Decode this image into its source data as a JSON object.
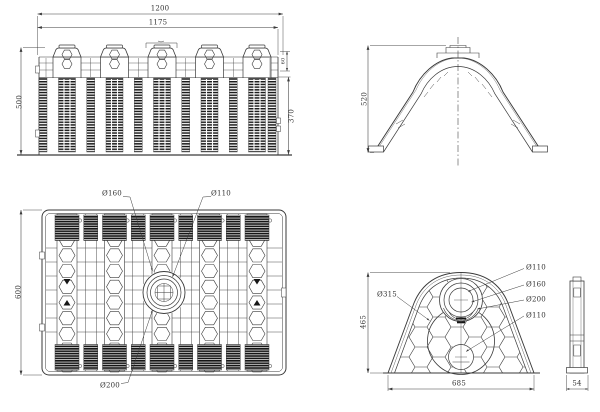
{
  "colors": {
    "line": "#3a3a3a",
    "dark_fill": "#161616",
    "background": "#ffffff"
  },
  "front_view": {
    "width_overall": "1200",
    "width_upper": "1175",
    "height_overall": "500",
    "height_lower": "370",
    "height_upper": "60"
  },
  "side_view": {
    "height": "520"
  },
  "plan_view": {
    "depth": "600",
    "port_top_left": "Ø160",
    "port_top_right": "Ø110",
    "port_bottom": "Ø200"
  },
  "end_view": {
    "height": "465",
    "width": "685",
    "thickness": "54",
    "port_1": "Ø110",
    "port_2": "Ø160",
    "port_3": "Ø200",
    "port_4": "Ø110",
    "port_center": "Ø315"
  }
}
